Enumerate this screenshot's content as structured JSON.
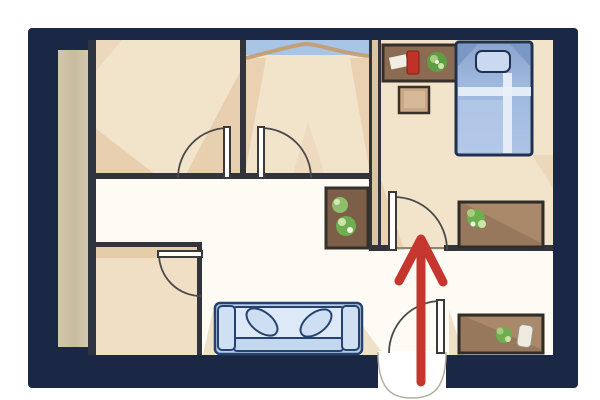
{
  "scene": {
    "type": "apartment-floor-plan-illustration",
    "annotation": "red arrow entering through front door pointing straight toward bedroom door",
    "palette": {
      "frame_navy": "#1b2845",
      "floor_tan": "#f2e3cb",
      "hall_white": "#fdfbf4",
      "wall_dark": "#33343a",
      "arrow_red": "#c5372e",
      "wood_brown": "#8b6c53",
      "cabinet_brown": "#97785c",
      "sofa_blue": "#b7cee9",
      "bed_blue": "#9db7de",
      "plant_green": "#6fae4e",
      "balcony_tan": "#cdc2a7",
      "window_blue": "#a9c5e5",
      "accent_red_object": "#bf3129"
    },
    "rooms": [
      {
        "id": "room-top-left",
        "kind": "room"
      },
      {
        "id": "room-top-middle",
        "kind": "room"
      },
      {
        "id": "bedroom-top-right",
        "kind": "bedroom"
      },
      {
        "id": "bathroom-bottom-left",
        "kind": "small room"
      },
      {
        "id": "living-hall",
        "kind": "hallway / living area"
      },
      {
        "id": "entry-nook-bottom-right",
        "kind": "entry corner"
      }
    ],
    "doors": [
      "entry-door",
      "bedroom-door",
      "room-left-door",
      "room-middle-door",
      "bathroom-door"
    ],
    "furniture": [
      "bed-with-pillow",
      "dresser-with-red-box-and-plant",
      "side-stool",
      "hall-cabinet-with-plants",
      "sideboard-with-plant-upper",
      "sideboard-with-plant-and-vase-lower",
      "sofa-with-two-cushions",
      "balcony-strip"
    ]
  }
}
